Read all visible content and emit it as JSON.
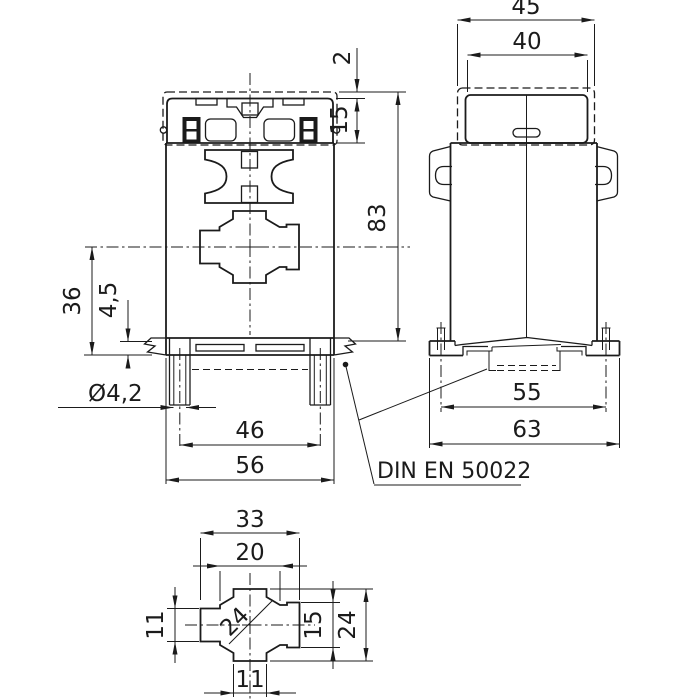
{
  "drawing": {
    "note": {
      "din_rail_standard": "DIN EN 50022"
    },
    "front_view": {
      "overall_width": "56",
      "mount_hole_spacing": "46",
      "center_to_base": "36",
      "rail_seat_depth": "4,5",
      "mount_hole_dia": "Ø4,2",
      "overall_height": "83",
      "terminal_height": "15",
      "cover_offset": "2"
    },
    "side_view": {
      "overall_depth": "45",
      "cover_depth": "40",
      "mount_slot_spacing": "55",
      "base_depth": "63"
    },
    "window_detail": {
      "slot_width": "33",
      "step_width": "20",
      "cable_dia": "24",
      "slot_height_left": "11",
      "step_height_right": "15",
      "opening_height": "24",
      "bottom_slot_width": "11"
    },
    "colors": {
      "line": "#1b1b1b",
      "background": "#ffffff"
    }
  }
}
